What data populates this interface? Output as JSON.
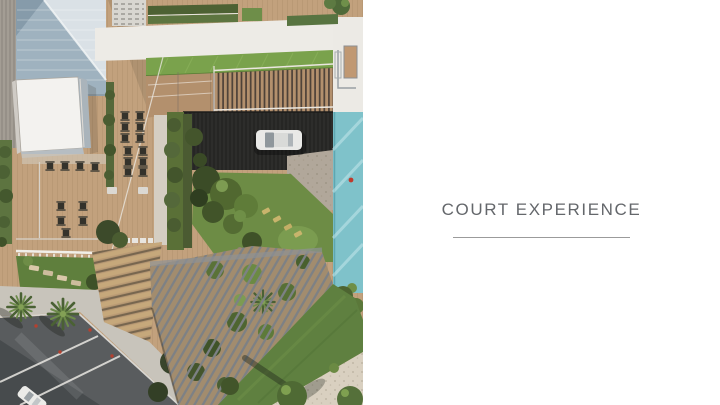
{
  "caption": {
    "title": "COURT EXPERIENCE",
    "title_color": "#64676b",
    "underline_color": "#9b9b9b"
  },
  "render": {
    "alt": "Aerial architectural rendering of a residential court: timber deck with cafe tables, a dark sunken drive court with a parked white car, central garden with trees, a lap pool along the right edge, louvred pergola over landscaping, lawns, amphitheater steps, palm trees and a street at lower left",
    "palette": {
      "deck_wood": "#c2a17d",
      "walkway_white": "#edebe6",
      "bright_lawn": "#7aa24c",
      "lawn_green": "#6d8c45",
      "court_floor": "#2d2d2b",
      "pool_teal": "#7fc2ca",
      "road_gray": "#595c5e",
      "paving_beige": "#d9d0c0",
      "roof_white": "#f3f2ef",
      "glass_blue": "#9fb2bf"
    }
  }
}
